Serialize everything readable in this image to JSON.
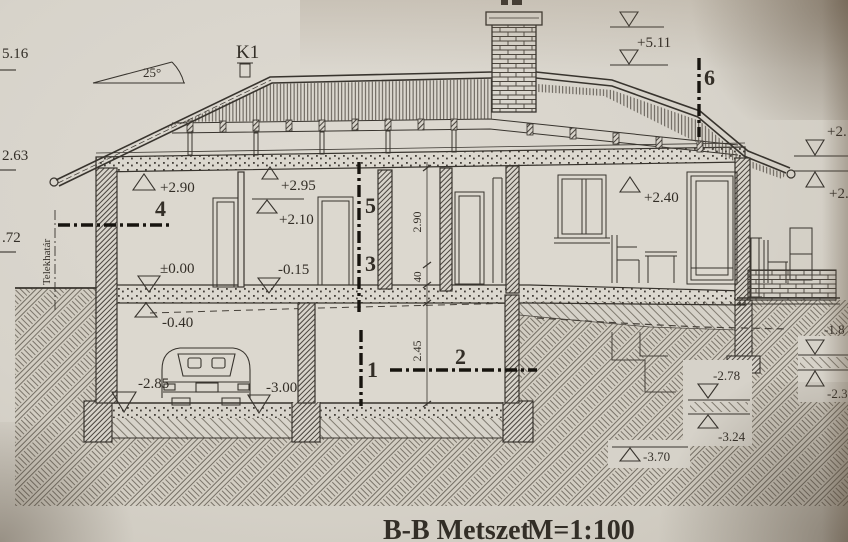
{
  "meta": {
    "title": "B-B Metszet",
    "scale": "M=1:100"
  },
  "annotations": {
    "roof_pitch": "25°",
    "window_mark": "K1",
    "property_line": "Telekhatár"
  },
  "sections": {
    "s1": "1",
    "s2": "2",
    "s3": "3",
    "s4": "4",
    "s5": "5",
    "s6": "6"
  },
  "levels": {
    "cut_left_top": "5.16",
    "cut_left_mid": "2.63",
    "cut_left_low": ".72",
    "ridge": "+5.11",
    "attic_left": "+2.90",
    "attic_mid_upper": "+2.95",
    "attic_mid_lower": "+2.10",
    "floor_zero": "±0.00",
    "floor_mid": "-0.15",
    "attic_right": "+2.40",
    "right_cut_upper": "+2.",
    "right_cut_lower": "+2.",
    "basement_ceiling": "-0.40",
    "garage_floor": "-2.85",
    "basement_floor": "-3.00",
    "terrain_1": "-1.8",
    "terrain_2": "-2.78",
    "terrain_3": "-3.24",
    "terrain_4": "-2.3",
    "terrain_5": "-3.70"
  },
  "dimensions": {
    "ground_room_height": "2.90",
    "slab_thickness": "40",
    "basement_room_height": "2.45"
  }
}
